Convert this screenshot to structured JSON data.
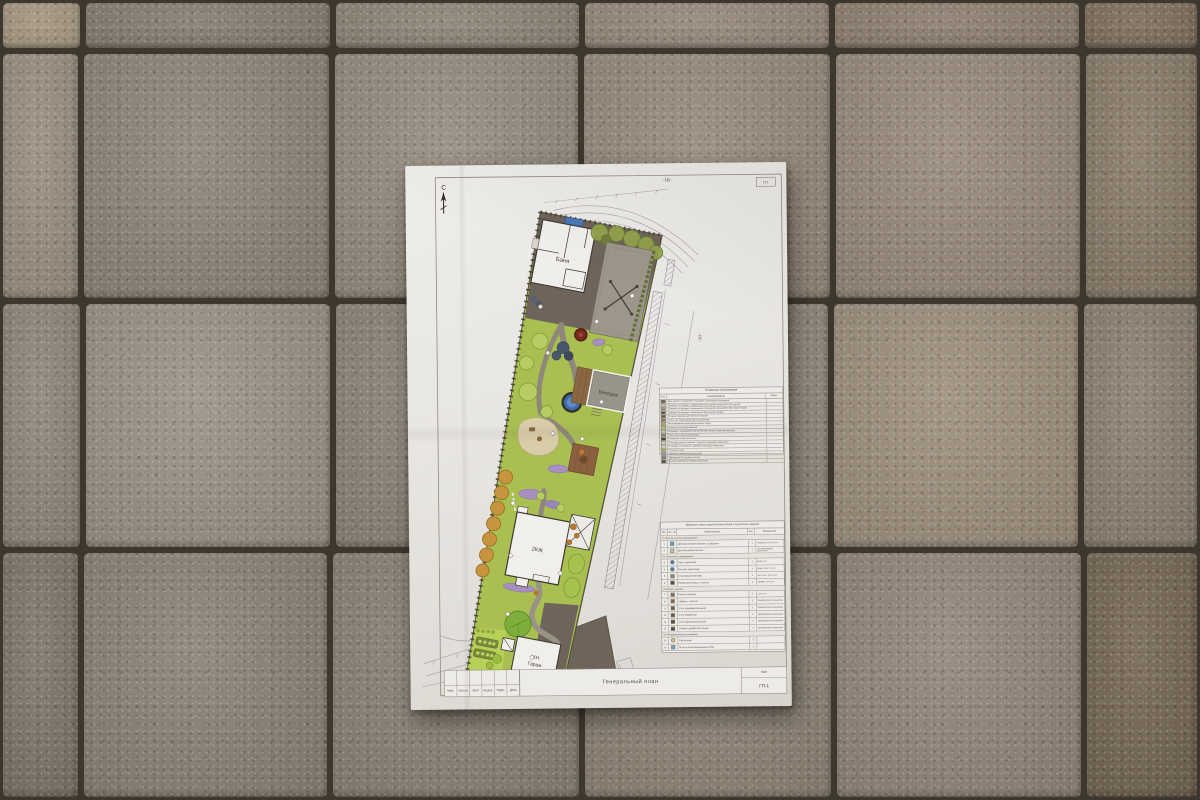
{
  "scene": {
    "pavement": {
      "joint_color": "#3e372d",
      "rows": [
        {
          "y": 0,
          "h": 51,
          "tiles": [
            {
              "x": 0,
              "w": 83,
              "c": "#a4967f"
            },
            {
              "x": 83,
              "w": 250,
              "c": "#857c70"
            },
            {
              "x": 333,
              "w": 249,
              "c": "#8d8376"
            },
            {
              "x": 582,
              "w": 250,
              "c": "#958779"
            },
            {
              "x": 832,
              "w": 250,
              "c": "#8c7e6e"
            },
            {
              "x": 1082,
              "w": 118,
              "c": "#7d6e5c"
            }
          ]
        },
        {
          "y": 51,
          "h": 250,
          "tiles": [
            {
              "x": 0,
              "w": 81,
              "c": "#998d7f"
            },
            {
              "x": 81,
              "w": 251,
              "c": "#8c8478"
            },
            {
              "x": 332,
              "w": 249,
              "c": "#948b7e"
            },
            {
              "x": 581,
              "w": 252,
              "c": "#95897b"
            },
            {
              "x": 833,
              "w": 250,
              "c": "#97897a"
            },
            {
              "x": 1083,
              "w": 117,
              "c": "#887a69"
            }
          ]
        },
        {
          "y": 301,
          "h": 249,
          "tiles": [
            {
              "x": 0,
              "w": 83,
              "c": "#8e8578"
            },
            {
              "x": 83,
              "w": 250,
              "c": "#9a9184"
            },
            {
              "x": 333,
              "w": 248,
              "c": "#8d8477"
            },
            {
              "x": 581,
              "w": 250,
              "c": "#938a7d"
            },
            {
              "x": 831,
              "w": 250,
              "c": "#9c8e7d"
            },
            {
              "x": 1081,
              "w": 119,
              "c": "#8c7f6f"
            }
          ]
        },
        {
          "y": 550,
          "h": 250,
          "tiles": [
            {
              "x": 0,
              "w": 81,
              "c": "#7d7569"
            },
            {
              "x": 81,
              "w": 249,
              "c": "#8a8175"
            },
            {
              "x": 330,
              "w": 252,
              "c": "#8a8176"
            },
            {
              "x": 582,
              "w": 252,
              "c": "#8e8376"
            },
            {
              "x": 834,
              "w": 250,
              "c": "#92847a"
            },
            {
              "x": 1084,
              "w": 116,
              "c": "#746654"
            }
          ]
        }
      ]
    }
  },
  "paper": {
    "north_label": "С",
    "top_dim_label": "–Щ–",
    "right_dim_label": "–Щ–",
    "corner_stamp_label": "ГП",
    "plan": {
      "labels": {
        "bath": "Баня",
        "gazebo": "Беседка",
        "house": "2КЖ",
        "garage_line1": "КН",
        "garage_line2": "Гараж"
      },
      "colors": {
        "lawn": "#a9bf52",
        "paving_dark": "#6e6459",
        "path_gray": "#8f887a",
        "pool_blue": "#3f6dac",
        "flower_purple": "#a78fc2",
        "orchard_orange": "#c79540",
        "deck_brown": "#8a6040",
        "patio_beige": "#d9cca9",
        "court_gray": "#9d978b"
      }
    },
    "legend": {
      "title": "Условные обозначения",
      "col_sym": "Усл. об.",
      "col_name": "Наименование",
      "col_note": "Прим.",
      "rows": [
        {
          "c": "#675d52",
          "name": "Дом жилой и сооружения, площадки с размерами сооружений"
        },
        {
          "c": "#ccc6bd",
          "name": "Дорожки и площадки с замощением тротуарной плиткой 300×300 (серый)"
        },
        {
          "c": "#968d80",
          "name": "Дорожки и площадки с замощением тротуарной плиткой 600×300 (тёмно-серый)"
        },
        {
          "c": "#564c41",
          "name": "Дорожки и площадки с замощением брусчаткой (графит)"
        },
        {
          "c": "#6f5b42",
          "name": "Мощение деревянной террасной доской"
        },
        {
          "c": "#8a6e4b",
          "name": "Настил из террасной доски (лиственница)"
        },
        {
          "c": "#b1a474",
          "name": "Мульчирование корой декоративных пород"
        },
        {
          "c": "#c4cc4e",
          "name": "Отмостка газонной решёткой"
        },
        {
          "c": "#cfd0c2",
          "name": "Парковка с замощением экологической плиткой (газонная решётка)"
        },
        {
          "c": "#8f8a7e",
          "name": "Покрытие из резиновой крошки"
        },
        {
          "c": "#4f463c",
          "name": "Подпорная стенка из бетона"
        },
        {
          "c": "#d9d6cb",
          "name": "Площадка детская игровая с ударопоглощающим покрытием"
        },
        {
          "c": "#d9d6cb",
          "name": "Площадка спортивная с ударопоглощающим покрытием"
        },
        {
          "c": "#9cbb42",
          "name": "Рулонный газон"
        },
        {
          "c": "#a18fb5",
          "name": "Цветник из многолетних растений"
        },
        {
          "c": "#7a7468",
          "name": "Ограждение по границе участка"
        },
        {
          "c": "#55493e",
          "name": "Благоустройство по границе разработки"
        }
      ]
    },
    "maf": {
      "title": "Ведомость малых архитектурных форм и переносных изделий",
      "cols": [
        "Поз.",
        "Усл. об.",
        "Наименование",
        "Кол.",
        "Примечание"
      ],
      "rows": [
        {
          "section": "01 Детское игровое оборудование"
        },
        {
          "pos": "1",
          "ic": {
            "t": "sq",
            "c": "#6aa0c8"
          },
          "name": "Детский игровой комплекс «Савушка»",
          "qty": "1",
          "note": "Габарит 4,2×3,4×3,2 м"
        },
        {
          "pos": "2",
          "ic": {
            "t": "sq",
            "c": "#c9c4ba"
          },
          "name": "Детский домик-палатка",
          "qty": "1",
          "note": "Устанавливается заказчиком"
        },
        {
          "section": "02 Спортивное оборудование"
        },
        {
          "pos": "3",
          "ic": {
            "t": "ci",
            "c": "#4a79b8"
          },
          "name": "Батут каркасный",
          "qty": "1",
          "note": "Диам. 3 м"
        },
        {
          "pos": "4",
          "ic": {
            "t": "ci",
            "c": "#4a79b8"
          },
          "name": "Бассейн каркасный",
          "qty": "1",
          "note": "Диам. 3,6 м, h 1,2 м"
        },
        {
          "pos": "5",
          "ic": {
            "t": "sq",
            "c": "#8f8a7e"
          },
          "name": "Спортивный комплекс",
          "qty": "1",
          "note": "Тип «луч», 3,5×2,3 м"
        },
        {
          "pos": "6",
          "ic": {
            "t": "sq",
            "c": "#564c41"
          },
          "name": "Мобильная качель с тентом",
          "qty": "1",
          "note": "Габарит 3,5×2,2 м"
        },
        {
          "section": "03 Мебель садовая"
        },
        {
          "pos": "7",
          "ic": {
            "t": "sq",
            "c": "#8a6e4b"
          },
          "name": "Качели садовые",
          "qty": "1",
          "note": "2,0×1,2 м"
        },
        {
          "pos": "8",
          "ic": {
            "t": "sq",
            "c": "#8a6040"
          },
          "name": "«Диван» + кресла",
          "qty": "1",
          "note": "Приобретается заказчиком"
        },
        {
          "pos": "9",
          "ic": {
            "t": "sq",
            "c": "#6f5b42"
          },
          "name": "Стол кофейный большой",
          "qty": "1",
          "note": "Приобретается заказчиком"
        },
        {
          "pos": "10",
          "ic": {
            "t": "sq",
            "c": "#6f5b42"
          },
          "name": "Стол обеденный",
          "qty": "1",
          "note": "Приобретается заказчиком"
        },
        {
          "pos": "11",
          "ic": {
            "t": "sq",
            "c": "#564c41"
          },
          "name": "Стол журнальный малый",
          "qty": "1",
          "note": "Приобретается заказчиком"
        },
        {
          "pos": "12",
          "ic": {
            "t": "sq",
            "c": "#564c41"
          },
          "name": "Скамья садовая без спинки",
          "qty": "2",
          "note": "Приобретается заказчиком"
        },
        {
          "section": "04 Оборудование для освещения"
        },
        {
          "pos": "13",
          "ic": {
            "t": "ci",
            "c": "#d8cf6a"
          },
          "name": "Светильник",
          "qty": "5",
          "note": ""
        },
        {
          "pos": "14",
          "ic": {
            "t": "sq",
            "c": "#6aa0c8"
          },
          "name": "Розетка влагозащищённая IP-65",
          "qty": "3",
          "note": ""
        }
      ]
    },
    "stamp": {
      "small_cells": [
        "Изм.",
        "Кол.уч",
        "Лист",
        "№ док.",
        "Подп.",
        "Дата"
      ],
      "title": "Генеральный план",
      "sheet_label": "Лист",
      "sheet_value": "ГП-1"
    }
  }
}
